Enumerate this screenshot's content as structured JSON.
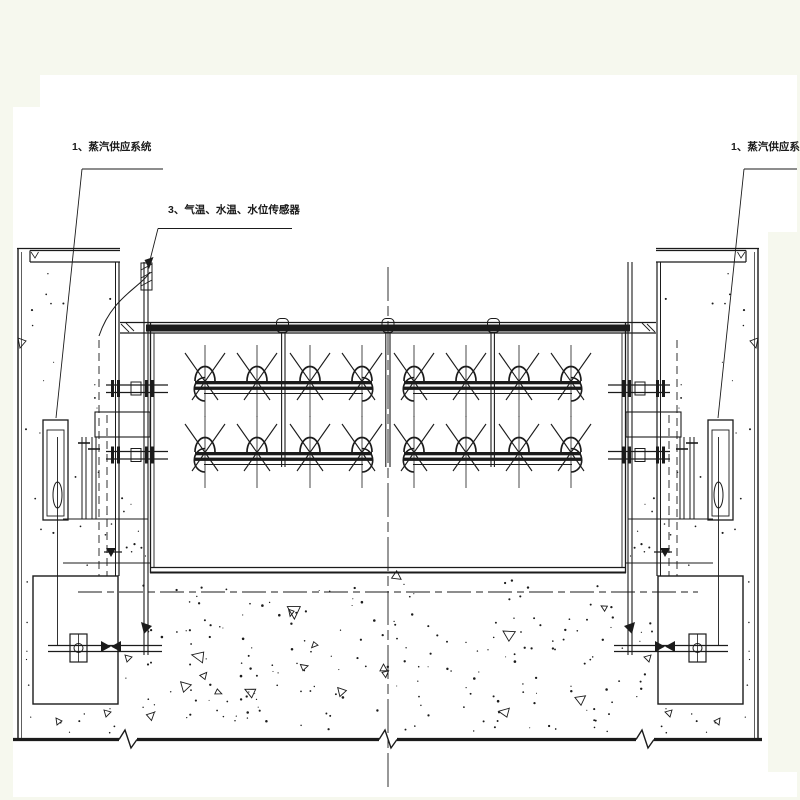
{
  "labels": {
    "steam_left": "1、蒸汽供应系统",
    "sensors": "3、气温、水温、水位传感器",
    "steam_right": "1、蒸汽供应系统"
  },
  "colors": {
    "background": "#f6f8ee",
    "paper": "#ffffff",
    "line": "#1b1b1b"
  },
  "drawing": {
    "kind": "engineering elevation drawing",
    "left_label_number": "1",
    "middle_label_number": "3",
    "right_label_number": "1"
  }
}
